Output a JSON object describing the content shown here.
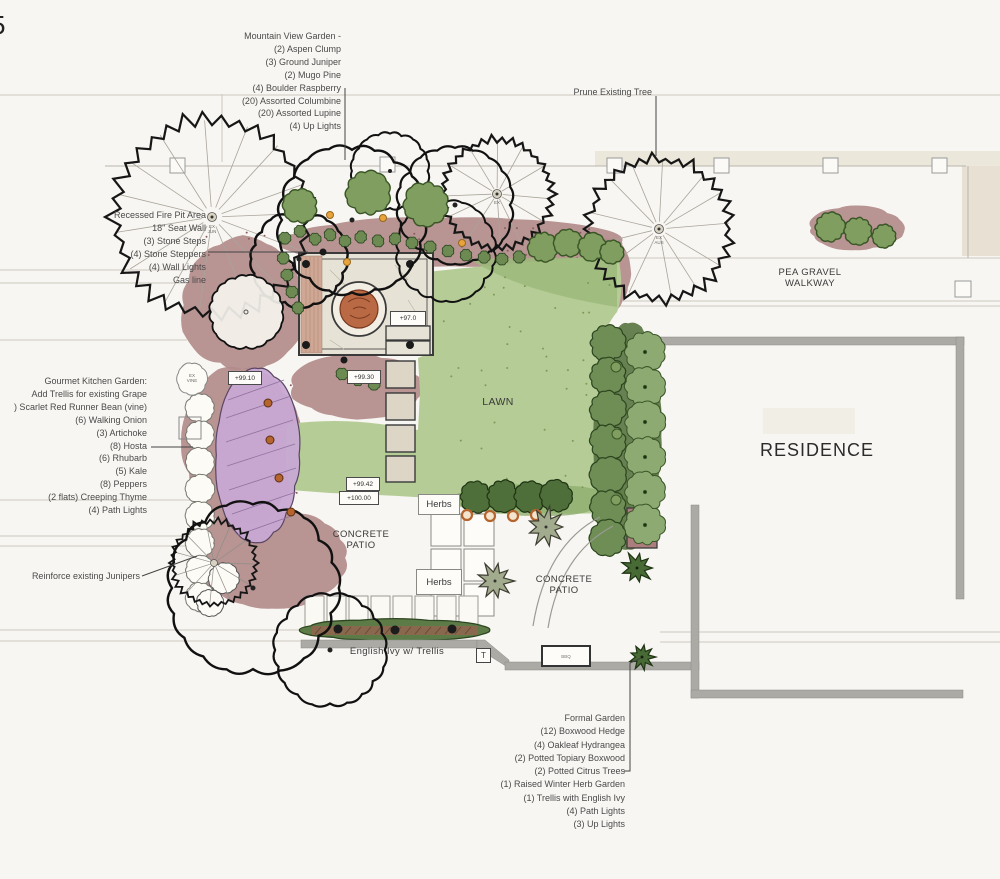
{
  "corner_mark": "5",
  "annotations": {
    "mountain_view": [
      "Mountain View Garden -",
      "(2) Aspen Clump",
      "(3) Ground Juniper",
      "(2) Mugo Pine",
      "(4) Boulder Raspberry",
      "(20) Assorted Columbine",
      "(20) Assorted Lupine",
      "(4) Up Lights"
    ],
    "fire_pit": [
      "Recessed Fire Pit Area",
      "18\" Seat Wall",
      "(3) Stone Steps",
      "(4) Stone Steppers",
      "(4) Wall Lights",
      "Gas line"
    ],
    "kitchen_garden": [
      "Gourmet Kitchen Garden:",
      "Add Trellis for existing Grape",
      ") Scarlet Red Runner Bean (vine)",
      "(6) Walking Onion",
      "(3) Artichoke",
      "(8) Hosta",
      "(6) Rhubarb",
      "(5) Kale",
      "(8) Peppers",
      "(2 flats) Creeping Thyme",
      "(4) Path Lights"
    ],
    "formal_garden": [
      "Formal Garden",
      "(12) Boxwood Hedge",
      "(4) Oakleaf Hydrangea",
      "(2) Potted Topiary Boxwood",
      "(2) Potted Citrus Trees",
      "(1) Raised Winter Herb Garden",
      "(1) Trellis with English Ivy",
      "(4) Path Lights",
      "(3) Up Lights"
    ],
    "reinforce_junipers": "Reinforce existing Junipers",
    "prune_tree": "Prune Existing Tree"
  },
  "site_labels": {
    "pea_gravel_line1": "PEA GRAVEL",
    "pea_gravel_line2": "WALKWAY",
    "residence": "RESIDENCE",
    "lawn": "LAWN",
    "concrete_line1": "CONCRETE",
    "concrete_line2": "PATIO",
    "herbs": "Herbs",
    "english_ivy": "English Ivy w/ Trellis",
    "gate": "T",
    "bbq": "BBQ"
  },
  "elevation_markers": {
    "patio": "+97.0",
    "upper_steps": "+99.30",
    "bed": "+99.10",
    "lower_steps": "+99.42",
    "patio_edge": "+100.00"
  },
  "existing_plant_tags": {
    "vine1": "EX",
    "vine2": "VINE",
    "juniper1": "EX",
    "juniper2": "JUN",
    "aspen": "EX",
    "pine1": "EX",
    "pine2": "AUS"
  },
  "colors": {
    "bed": "#b28b8b",
    "kitchen_bed": "#c7a8d2",
    "lawn": "#b5cc96",
    "hedge_dark": "#6f8e55",
    "hedge_light": "#8caa72",
    "stone": "#e7e2d6",
    "fire_pit": "#b96a45",
    "wall_gray": "#abaaa5",
    "trellis_green": "#5d7b47"
  }
}
